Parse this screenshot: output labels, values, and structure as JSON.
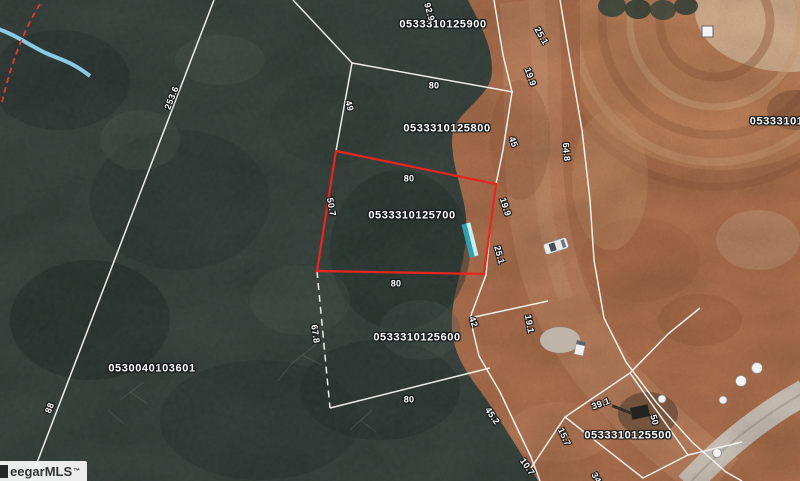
{
  "map": {
    "description": "aerial parcel map with highlighted lot",
    "parcel_labels": [
      {
        "text": "0533310125900",
        "x": 443,
        "y": 25,
        "rot": 0
      },
      {
        "text": "0533310125800",
        "x": 447,
        "y": 129,
        "rot": 0
      },
      {
        "text": "0533310125700",
        "x": 412,
        "y": 216,
        "rot": 0,
        "highlighted": true
      },
      {
        "text": "0533310125600",
        "x": 417,
        "y": 338,
        "rot": 0
      },
      {
        "text": "0530040103601",
        "x": 152,
        "y": 369,
        "rot": 0
      },
      {
        "text": "0533310125500",
        "x": 628,
        "y": 436,
        "rot": 0
      },
      {
        "text": "053331012",
        "x": 780,
        "y": 122,
        "rot": 0
      }
    ],
    "dimension_labels": [
      {
        "text": "92.9",
        "x": 429,
        "y": 12,
        "rot": 75
      },
      {
        "text": "25.1",
        "x": 541,
        "y": 36,
        "rot": 60
      },
      {
        "text": "19.9",
        "x": 530,
        "y": 77,
        "rot": 70
      },
      {
        "text": "80",
        "x": 434,
        "y": 86,
        "rot": 0
      },
      {
        "text": "49",
        "x": 349,
        "y": 106,
        "rot": 75
      },
      {
        "text": "45",
        "x": 513,
        "y": 142,
        "rot": 70
      },
      {
        "text": "64.8",
        "x": 566,
        "y": 152,
        "rot": 85
      },
      {
        "text": "80",
        "x": 409,
        "y": 179,
        "rot": 0
      },
      {
        "text": "50.7",
        "x": 331,
        "y": 207,
        "rot": 80
      },
      {
        "text": "19.9",
        "x": 505,
        "y": 207,
        "rot": 72
      },
      {
        "text": "25.1",
        "x": 499,
        "y": 255,
        "rot": 75
      },
      {
        "text": "80",
        "x": 396,
        "y": 284,
        "rot": 0
      },
      {
        "text": "67.8",
        "x": 315,
        "y": 334,
        "rot": 82
      },
      {
        "text": "42",
        "x": 473,
        "y": 322,
        "rot": 70
      },
      {
        "text": "19.1",
        "x": 529,
        "y": 324,
        "rot": 80
      },
      {
        "text": "80",
        "x": 409,
        "y": 400,
        "rot": 0
      },
      {
        "text": "45.2",
        "x": 492,
        "y": 416,
        "rot": 55
      },
      {
        "text": "39.1",
        "x": 601,
        "y": 404,
        "rot": -20
      },
      {
        "text": "50",
        "x": 654,
        "y": 420,
        "rot": 75
      },
      {
        "text": "15.7",
        "x": 564,
        "y": 437,
        "rot": 65
      },
      {
        "text": "10.7",
        "x": 527,
        "y": 467,
        "rot": 55
      },
      {
        "text": "34",
        "x": 596,
        "y": 478,
        "rot": 60
      },
      {
        "text": "253.6",
        "x": 172,
        "y": 98,
        "rot": -68
      },
      {
        "text": "88",
        "x": 50,
        "y": 408,
        "rot": -68
      }
    ],
    "watermark": {
      "text": "eegarMLS",
      "tm": "™"
    },
    "colors": {
      "parcel_highlight": "#e8251f",
      "boundary_lines": "#f7f7f2",
      "stream": "#8ed2f0",
      "dashed_line": "#e23b2e",
      "dirt": "#b3734f",
      "forest": "#3a4540"
    }
  }
}
